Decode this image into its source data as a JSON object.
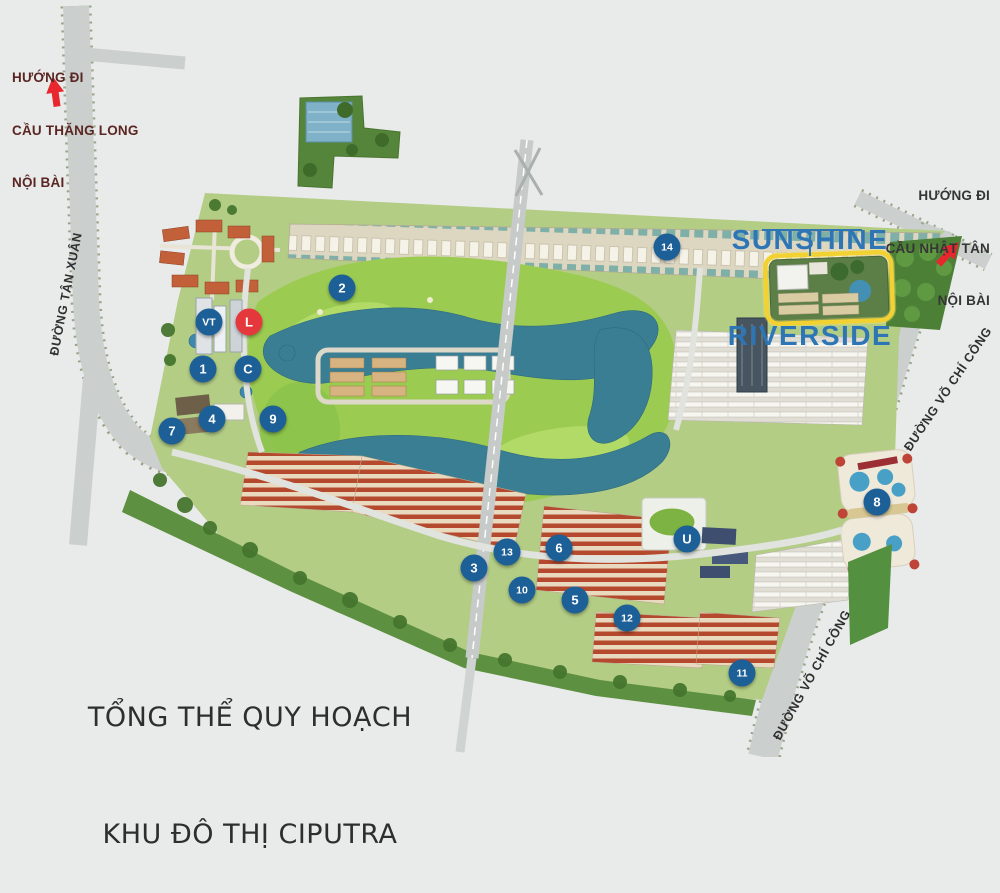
{
  "title": {
    "line1": "TỔNG THỂ QUY HOẠCH",
    "line2": "KHU ĐÔ THỊ CIPUTRA"
  },
  "project": {
    "line1": "SUNSHINE",
    "line2": "RIVERSIDE",
    "color": "#2e75b6"
  },
  "directions": {
    "left": {
      "line1": "HƯỚNG ĐI",
      "line2": "CẦU THĂNG LONG",
      "line3": "NỘI BÀI"
    },
    "right": {
      "line1": "HƯỚNG ĐI",
      "line2": "CẦU NHẬT TÂN",
      "line3": "NỘI BÀI"
    }
  },
  "roads": {
    "tan_xuan": "ĐƯỜNG TÂN XUÂN",
    "vo_chi_cong_upper": "ĐƯỜNG VÕ CHÍ CÔNG",
    "vo_chi_cong_lower": "ĐƯỜNG VÕ CHÍ CÔNG"
  },
  "map": {
    "highlight_color": "#f2d232",
    "marker_blue": "#1d5f97",
    "marker_red": "#e5383c",
    "arrow_red": "#e8262d",
    "markers": [
      {
        "label": "VT",
        "x": 209,
        "y": 322
      },
      {
        "label": "L",
        "x": 249,
        "y": 322,
        "variant": "red"
      },
      {
        "label": "1",
        "x": 203,
        "y": 369
      },
      {
        "label": "C",
        "x": 248,
        "y": 369
      },
      {
        "label": "2",
        "x": 342,
        "y": 288
      },
      {
        "label": "4",
        "x": 212,
        "y": 419
      },
      {
        "label": "7",
        "x": 172,
        "y": 431
      },
      {
        "label": "9",
        "x": 273,
        "y": 419
      },
      {
        "label": "14",
        "x": 667,
        "y": 247
      },
      {
        "label": "3",
        "x": 474,
        "y": 568
      },
      {
        "label": "13",
        "x": 507,
        "y": 552
      },
      {
        "label": "6",
        "x": 559,
        "y": 548
      },
      {
        "label": "U",
        "x": 687,
        "y": 539
      },
      {
        "label": "10",
        "x": 522,
        "y": 590
      },
      {
        "label": "5",
        "x": 575,
        "y": 600
      },
      {
        "label": "12",
        "x": 627,
        "y": 618
      },
      {
        "label": "11",
        "x": 742,
        "y": 673
      },
      {
        "label": "8",
        "x": 877,
        "y": 502
      }
    ]
  }
}
